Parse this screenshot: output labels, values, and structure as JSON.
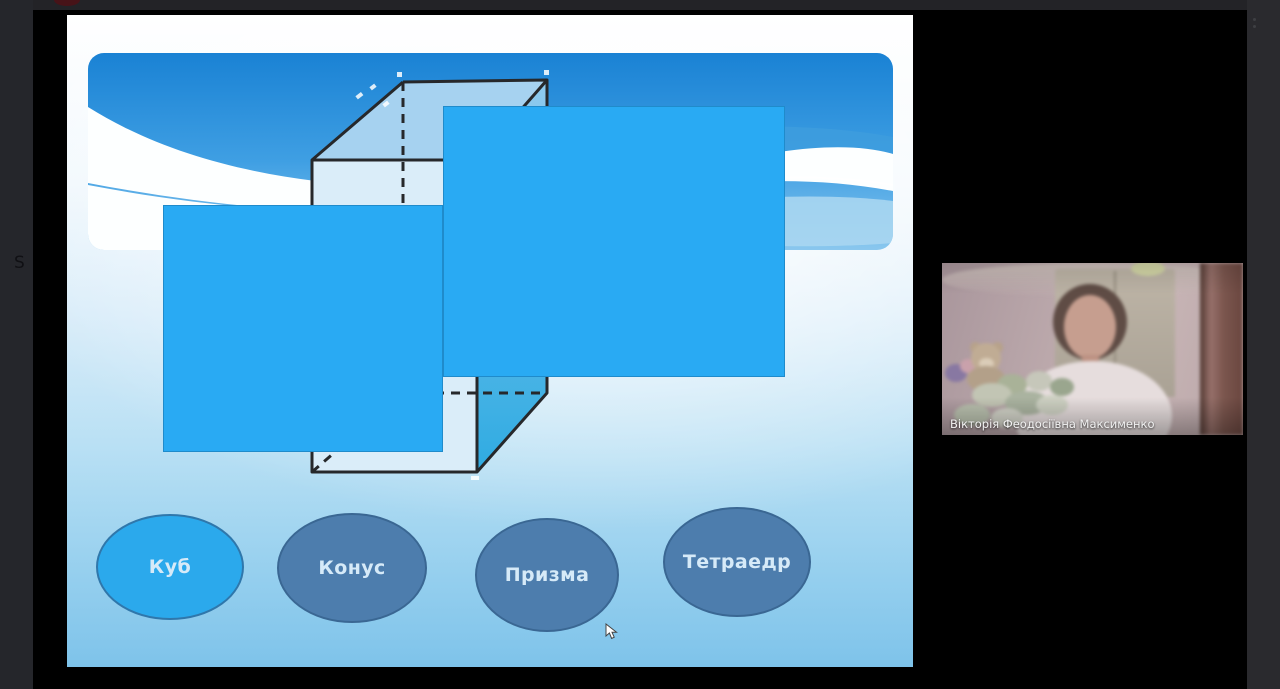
{
  "chrome": {
    "left_rail_letter": "S",
    "menu_icon": "vertical-ellipsis",
    "recording_indicator_color": "#471318"
  },
  "slide": {
    "figure": {
      "type": "cuboid-wireframe",
      "hidden_edges_style": "dashed",
      "covered_by": [
        "left-blue-rectangle",
        "right-blue-rectangle"
      ]
    },
    "answer_options": [
      {
        "label": "Куб",
        "state": "highlighted"
      },
      {
        "label": "Конус",
        "state": "default"
      },
      {
        "label": "Призма",
        "state": "default"
      },
      {
        "label": "Тетраедр",
        "state": "default"
      }
    ]
  },
  "participant": {
    "name_label": "Вікторія Феодосіївна Максименко"
  },
  "colors": {
    "cover": "#29aaf3",
    "ovalActive": "#2ba9ec",
    "ovalActiveBorder": "#2f77ab",
    "oval": "#4d7dad",
    "ovalBorder": "#3a6793",
    "ovalText": "#d6eaf8",
    "bannerTop": "#1a82d4",
    "bannerLow": "#63b5ec",
    "slideBottom": "#7ec3ea",
    "figureEdge": "#26282b",
    "figureTopFace": "#a6d2f0",
    "figureFrontFace": "#daedf9",
    "figureRightFace": "#2fabe2"
  }
}
